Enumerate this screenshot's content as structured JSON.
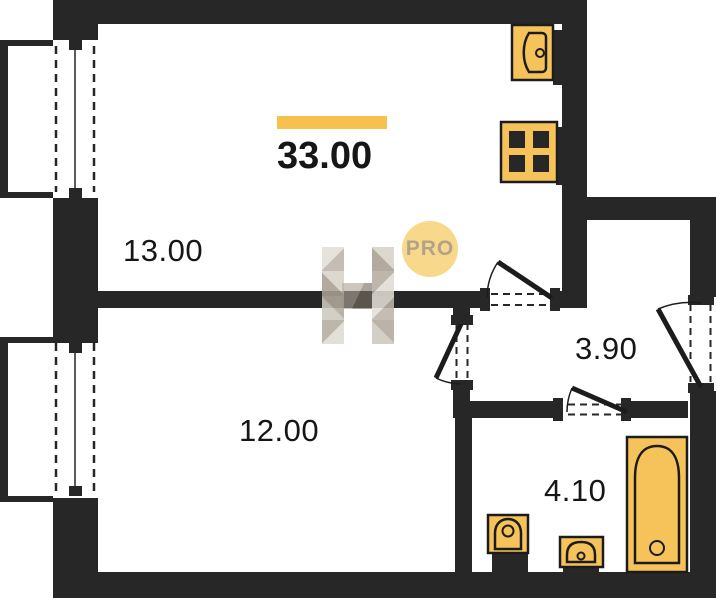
{
  "plan": {
    "type": "apartment-floor-plan",
    "total_area": {
      "value": "33.00",
      "highlighted": true
    },
    "rooms": [
      {
        "id": "room-top",
        "label": "13.00"
      },
      {
        "id": "room-bottom",
        "label": "12.00"
      },
      {
        "id": "hallway",
        "label": "3.90"
      },
      {
        "id": "bathroom",
        "label": "4.10"
      }
    ],
    "badge": {
      "label": "PRO"
    },
    "watermark": {
      "letter": "H"
    },
    "fixtures": [
      "kitchen-sink-icon",
      "stove-icon",
      "toilet-icon",
      "washbasin-icon",
      "bathtub-icon"
    ],
    "openings": [
      "window-left-top",
      "window-left-bottom",
      "door-room-top",
      "door-room-bottom",
      "door-bathroom",
      "door-entry"
    ],
    "colors": {
      "wall": "#272727",
      "fixture_fill": "#F6C35B",
      "highlight_bar": "#F6C14F",
      "badge_bg": "#F8D98B",
      "badge_text": "#b2a28a"
    }
  }
}
